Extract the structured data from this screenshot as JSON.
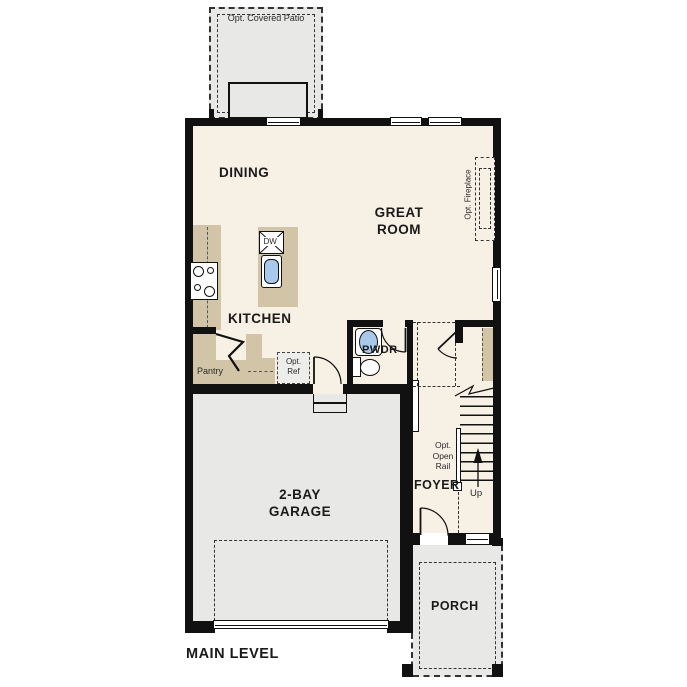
{
  "plan_title": "MAIN LEVEL",
  "rooms": {
    "patio": "Opt. Covered Patio",
    "dining": "DINING",
    "great_room_line1": "GREAT",
    "great_room_line2": "ROOM",
    "kitchen": "KITCHEN",
    "pantry": "Pantry",
    "powder": "PWDR",
    "foyer": "FOYER",
    "garage_line1": "2-BAY",
    "garage_line2": "GARAGE",
    "porch": "PORCH"
  },
  "annotations": {
    "dishwasher": "DW",
    "opt_ref_line1": "Opt.",
    "opt_ref_line2": "Ref",
    "opt_fireplace": "Opt. Fireplace",
    "opt_open_rail_line1": "Opt.",
    "opt_open_rail_line2": "Open",
    "opt_open_rail_line3": "Rail",
    "stairs_up": "Up"
  },
  "colors": {
    "wall": "#111111",
    "interior_floor": "#f7f0e4",
    "exterior_floor": "#e8e8e6",
    "cabinetry": "#d2c5a7",
    "water_fixture": "#a8c9ec"
  }
}
